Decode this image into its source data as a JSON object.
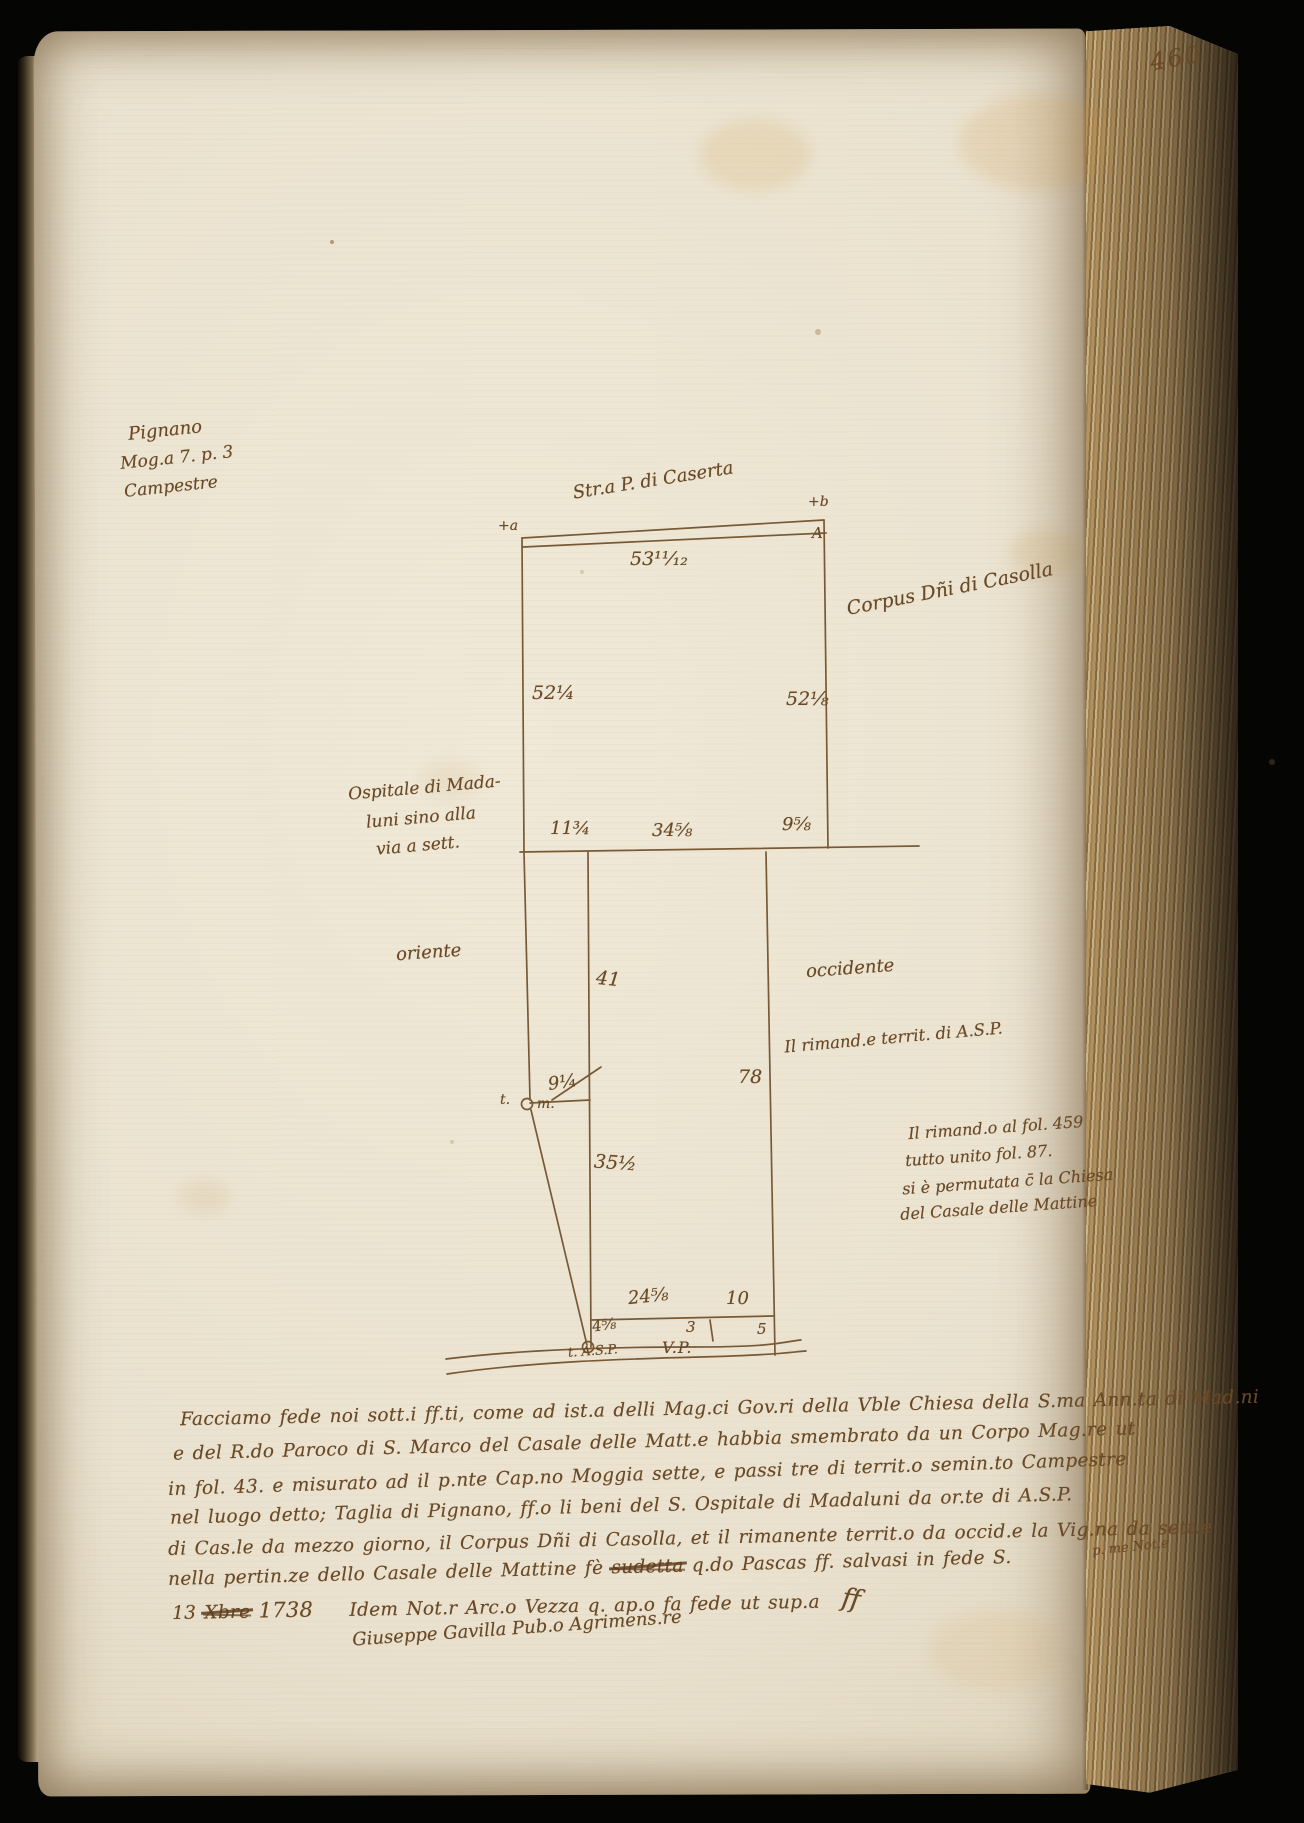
{
  "page": {
    "folio_number": "460"
  },
  "colors": {
    "ink": "#6a4926",
    "paper": "#eae2cf",
    "fore_edge": "#a98c5e"
  },
  "margin_note": {
    "place": "Pignano",
    "measure": "Mog.a 7. p. 3",
    "land_type": "Campestre"
  },
  "survey_map": {
    "road_top_label": "Str.a P. di Caserta",
    "corner_mark_left": "+a",
    "corner_mark_right": "+b",
    "corner_letter_right": "A",
    "measure_top": "53¹¹⁄₁₂",
    "measure_left": "52¼",
    "measure_right": "52⅛",
    "owner_right_label": "Corpus Dñi di Casolla",
    "owner_left_line1": "Ospitale di Mada-",
    "owner_left_line2": "luni sino alla",
    "owner_left_line3": "via a sett.",
    "measure_inner_left": "11¾",
    "measure_inner_mid": "34⅝",
    "measure_inner_right": "9⅝",
    "orient_east": "oriente",
    "orient_west": "occidente",
    "remainder_label": "Il rimand.e territ. di A.S.P.",
    "measure_strip_upper": "41",
    "measure_strip_right": "78",
    "measure_tick": "9¼",
    "terminus_mid_pre": "t.",
    "terminus_mid_post": "m.",
    "measure_strip_lower": "35½",
    "measure_bottom_left": "24⅝",
    "measure_bottom_right": "10",
    "measure_edge_left": "4⅝",
    "measure_edge_mid": "3",
    "measure_edge_right": "5",
    "terminus_bottom": "t. A.S.P.",
    "road_bottom_label": "V.P."
  },
  "side_note": {
    "line1": "Il rimand.o al fol. 459",
    "line2": "tutto unito fol. 87.",
    "line3": "si è permutata c̄ la Chiesa",
    "line4": "del Casale delle Mattine"
  },
  "attestation": {
    "line1": "Facciamo fede noi sott.i ff.ti, come ad ist.a delli Mag.ci Gov.ri della Vble Chiesa della S.ma Ann.ta di Mad.ni",
    "line2": "e del R.do Paroco di S. Marco del Casale delle Matt.e habbia smembrato da un Corpo Mag.re ut",
    "line3": "in fol. 43. e misurato ad il p.nte Cap.no Moggia sette, e passi tre di territ.o semin.to Campestre",
    "line4": "nel luogo detto; Taglia di Pignano, ff.o li beni del S. Ospitale di Madaluni da or.te di A.S.P.",
    "line5": "di Cas.le da mezzo giorno, il Corpus Dñi di Casolla, et il rimanente territ.o da occid.e la Vig.na da sett.e",
    "line6_pre": "nella pertin.ze dello Casale delle Mattine fè ",
    "line6_struck": "sudetta",
    "line6_post": " q.do Pascas ff. salvasi in fede S.",
    "line6_fragment": "p. me Not.e",
    "date_day": "13",
    "date_struck": "Xbre",
    "date_year": "1738",
    "notary_line": "Idem Not.r Arc.o Vezza q. ap.o fa fede ut sup.a",
    "paraph": "ﬀ",
    "signature": "Giuseppe Gavilla Pub.o Agrimens.re"
  }
}
